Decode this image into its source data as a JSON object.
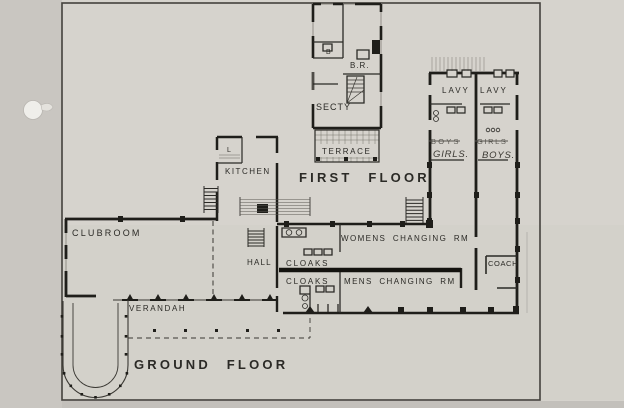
{
  "drawing": {
    "floor_titles": {
      "first": "FIRST FLOOR",
      "ground": "GROUND FLOOR"
    },
    "first_floor_flat": {
      "bath": "B",
      "bedroom": "B.R.",
      "secretary": "SECTY",
      "terrace": "TERRACE"
    },
    "lavatory_wing": {
      "lavy_left": "LAVY",
      "lavy_right": "LAVY",
      "left_typed": "BOYS",
      "left_handwritten": "GIRLS.",
      "right_typed": "GIRLS",
      "right_handwritten": "BOYS."
    },
    "ground_floor": {
      "clubroom": "CLUBROOM",
      "larder": "L",
      "kitchen": "KITCHEN",
      "hall": "HALL",
      "cloaks_upper": "CLOAKS",
      "cloaks_lower": "CLOAKS",
      "womens_changing": "WOMENS CHANGING RM",
      "mens_changing": "MENS CHANGING RM",
      "coach": "COACH",
      "verandah": "VERANDAH"
    },
    "colors": {
      "paper": "#d6d3cd",
      "margin": "#c9c6c1",
      "ink": "#2b2a26",
      "pencil": "#5d5b55"
    }
  }
}
